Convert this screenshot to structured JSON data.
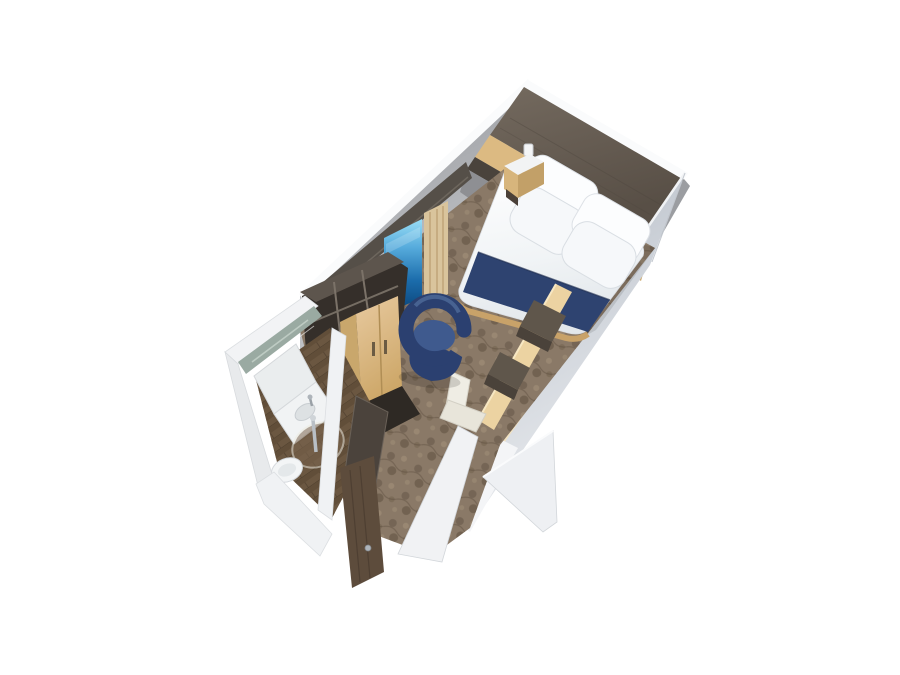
{
  "scene": {
    "title": "3D cutaway floor plan rendering of a cruise ship interior stateroom",
    "background": "#ffffff",
    "colors": {
      "wall_exterior": "#c2c8d1",
      "wall_interior": "#a4a6aa",
      "wall_white": "#eef0f2",
      "trim_white": "#fafbfc",
      "wood_dark_top": "#675e54",
      "wood_dark_face": "#4a433c",
      "wood_tan": "#dcba82",
      "wood_tan_dark": "#c9a76c",
      "soffit": "#554f48",
      "linen": "#f4f6f8",
      "pillow": "#fcfdfe",
      "navy": "#2e4370",
      "chair_navy": "#2b4070",
      "chair_navy_light": "#3f5a8e",
      "carpet": "#8a7967",
      "bath_floor": "#6b5741",
      "mirror": "#9aaaa2",
      "curtain": "#d9c49c",
      "door": "#5d4c3c",
      "desk_glow": "#ecd3a2",
      "desk_dark": "#5f564b",
      "chrome": "#aeb4ba",
      "chair_white": "#efede4"
    },
    "elements": [
      {
        "id": "headboard-wall",
        "label": "dark wood headboard wall with tan overhead cabinets"
      },
      {
        "id": "bed",
        "label": "double bed with white duvet, four pillows and navy runner"
      },
      {
        "id": "nightstand",
        "label": "bedside table with wall reading light"
      },
      {
        "id": "tv",
        "label": "wall-mounted TV showing blue ocean scene"
      },
      {
        "id": "shelf-unit",
        "label": "dark open shelving unit"
      },
      {
        "id": "wardrobe",
        "label": "tan two-door wardrobe"
      },
      {
        "id": "lounge-chair",
        "label": "round navy tub chair"
      },
      {
        "id": "desk",
        "label": "lit desk console along right wall"
      },
      {
        "id": "desk-chair",
        "label": "white desk chair"
      },
      {
        "id": "bathroom",
        "label": "bathroom with mirror, vanity sink, round glass shower and toilet"
      },
      {
        "id": "entry-door",
        "label": "open wood entry door with chrome handle"
      },
      {
        "id": "carpet",
        "label": "brown patterned carpet"
      },
      {
        "id": "corridor",
        "label": "entry corridor cutaway walls"
      }
    ]
  }
}
